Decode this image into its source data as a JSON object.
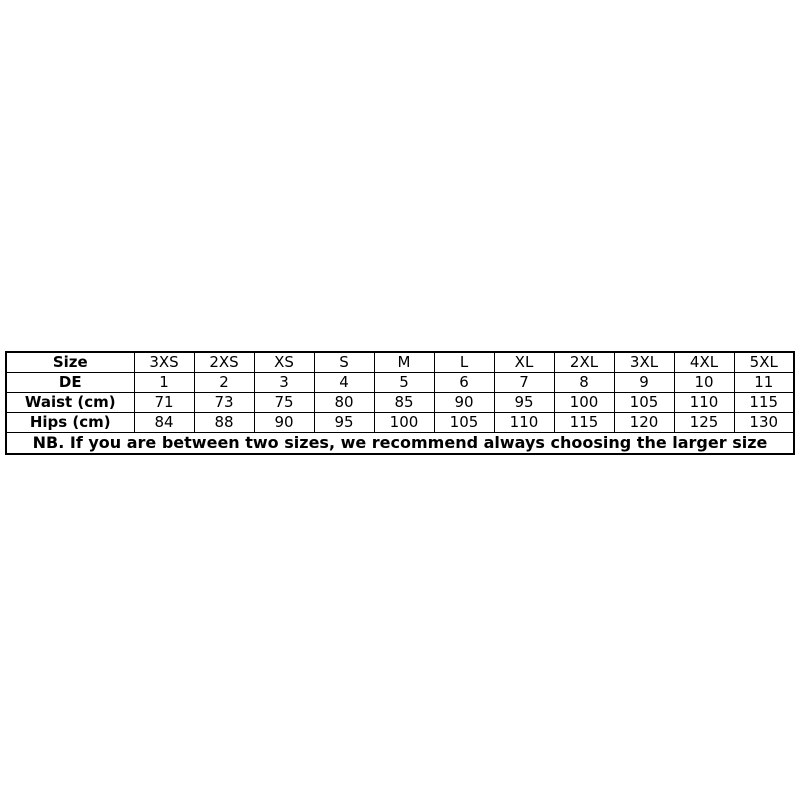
{
  "page": {
    "background": "#ffffff",
    "text_color": "#000000",
    "border_color": "#000000"
  },
  "chart_data": {
    "type": "table",
    "layout": {
      "grid": "all-borders",
      "first_column_bold": true,
      "note_row_bold": true
    },
    "rows": [
      {
        "label": "Size",
        "values": [
          "3XS",
          "2XS",
          "XS",
          "S",
          "M",
          "L",
          "XL",
          "2XL",
          "3XL",
          "4XL",
          "5XL"
        ]
      },
      {
        "label": "DE",
        "values": [
          1,
          2,
          3,
          4,
          5,
          6,
          7,
          8,
          9,
          10,
          11
        ]
      },
      {
        "label": "Waist (cm)",
        "values": [
          71,
          73,
          75,
          80,
          85,
          90,
          95,
          100,
          105,
          110,
          115
        ]
      },
      {
        "label": "Hips (cm)",
        "values": [
          84,
          88,
          90,
          95,
          100,
          105,
          110,
          115,
          120,
          125,
          130
        ]
      }
    ],
    "note": "NB. If you are between two sizes, we recommend always choosing the larger size"
  }
}
